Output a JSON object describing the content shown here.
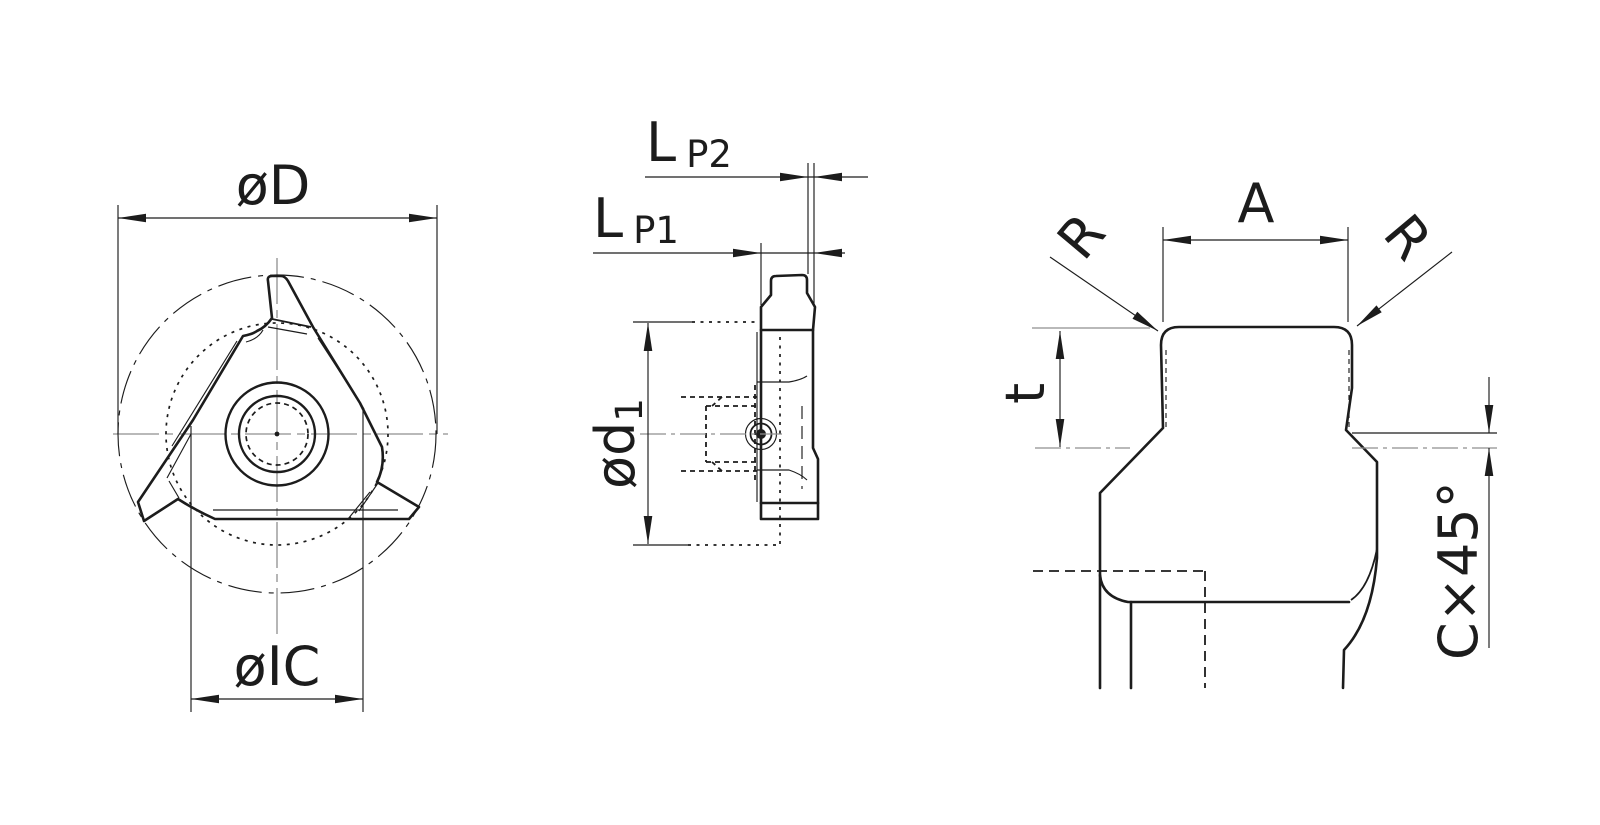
{
  "drawing_type": "technical drawing — triangular threading insert, three orthographic views",
  "colors": {
    "background": "#ffffff",
    "line": "#1c1c1c",
    "centerline": "#8f8f8f"
  },
  "front_view": {
    "dim_outer_diameter": "øD",
    "dim_inscribed_circle": "øIC"
  },
  "side_view": {
    "dim_length_p2": {
      "main": "L",
      "sub": "P2"
    },
    "dim_length_p1": {
      "main": "L",
      "sub": "P1"
    },
    "dim_bore_diameter": {
      "main": "ød",
      "sub": "1"
    }
  },
  "detail_view": {
    "dim_tip_width": "A",
    "dim_corner_radius_left": "R",
    "dim_corner_radius_right": "R",
    "dim_profile_depth": "t",
    "dim_chamfer": "C×45°"
  }
}
